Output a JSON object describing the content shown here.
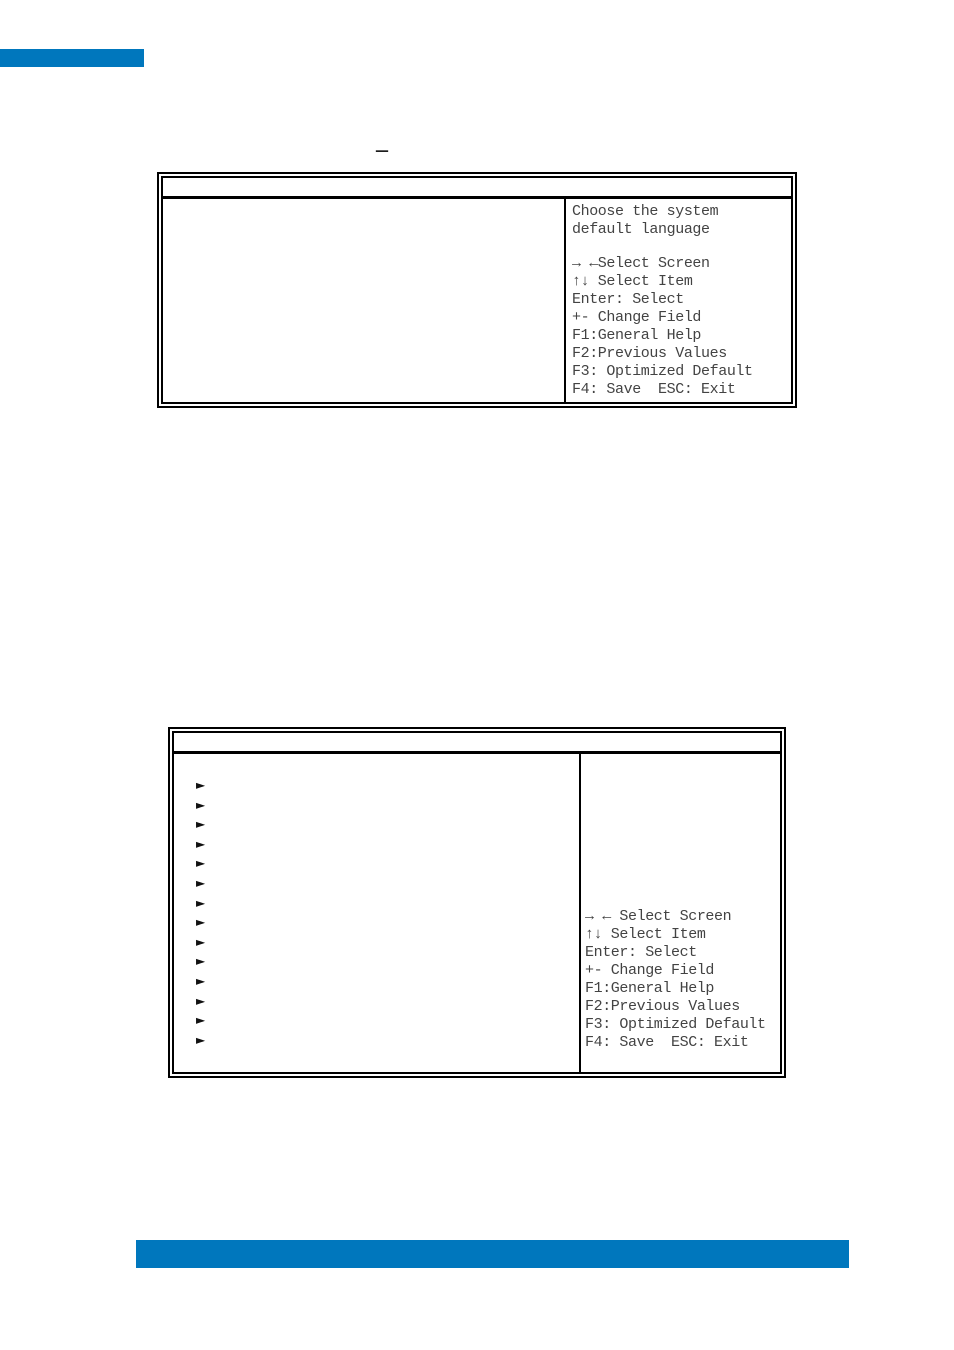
{
  "page": {
    "background": "#ffffff",
    "accent_blue": "#0077bd",
    "border_black": "#000000",
    "text_gray": "#434343"
  },
  "heading": {
    "dash": "–"
  },
  "screen1": {
    "title": "",
    "help": {
      "description": [
        "Choose the system",
        "default language"
      ],
      "keys": [
        "→ ←Select Screen",
        "↑↓ Select Item",
        "Enter: Select",
        "+- Change Field",
        "F1:General Help",
        "F2:Previous Values",
        "F3: Optimized Default",
        "F4: Save  ESC: Exit"
      ]
    }
  },
  "screen2": {
    "title": "",
    "menu_items": [
      "►",
      "►",
      "►",
      "►",
      "►",
      "►",
      "►",
      "►",
      "►",
      "►",
      "►",
      "►",
      "►",
      "►"
    ],
    "help": {
      "keys": [
        "→ ← Select Screen",
        "↑↓ Select Item",
        "Enter: Select",
        "+- Change Field",
        "F1:General Help",
        "F2:Previous Values",
        "F3: Optimized Default",
        "F4: Save  ESC: Exit"
      ]
    }
  }
}
